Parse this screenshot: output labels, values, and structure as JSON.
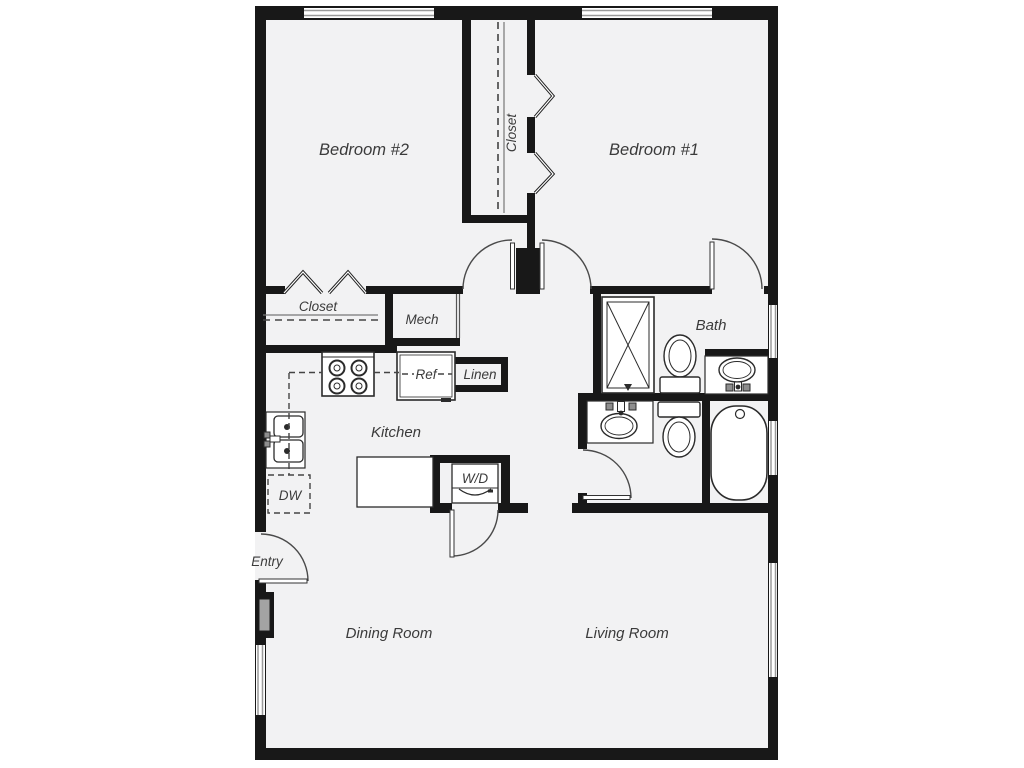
{
  "plan": {
    "type": "apartment-floor-plan",
    "labels": {
      "bedroom2": "Bedroom #2",
      "bedroom1": "Bedroom #1",
      "closet_bedroom1": "Closet",
      "closet_bedroom2": "Closet",
      "mech": "Mech",
      "ref": "Ref",
      "linen": "Linen",
      "bath": "Bath",
      "kitchen": "Kitchen",
      "dw": "DW",
      "wd": "W/D",
      "entry": "Entry",
      "dining": "Dining Room",
      "living": "Living Room"
    },
    "colors": {
      "wall": "#181818",
      "floor": "#f2f2f3",
      "fixture_line": "#2b2b2b",
      "label": "#3b3b3b",
      "window_frame": "#9a9a9a",
      "appliance_gray": "#8e8e8e"
    }
  }
}
